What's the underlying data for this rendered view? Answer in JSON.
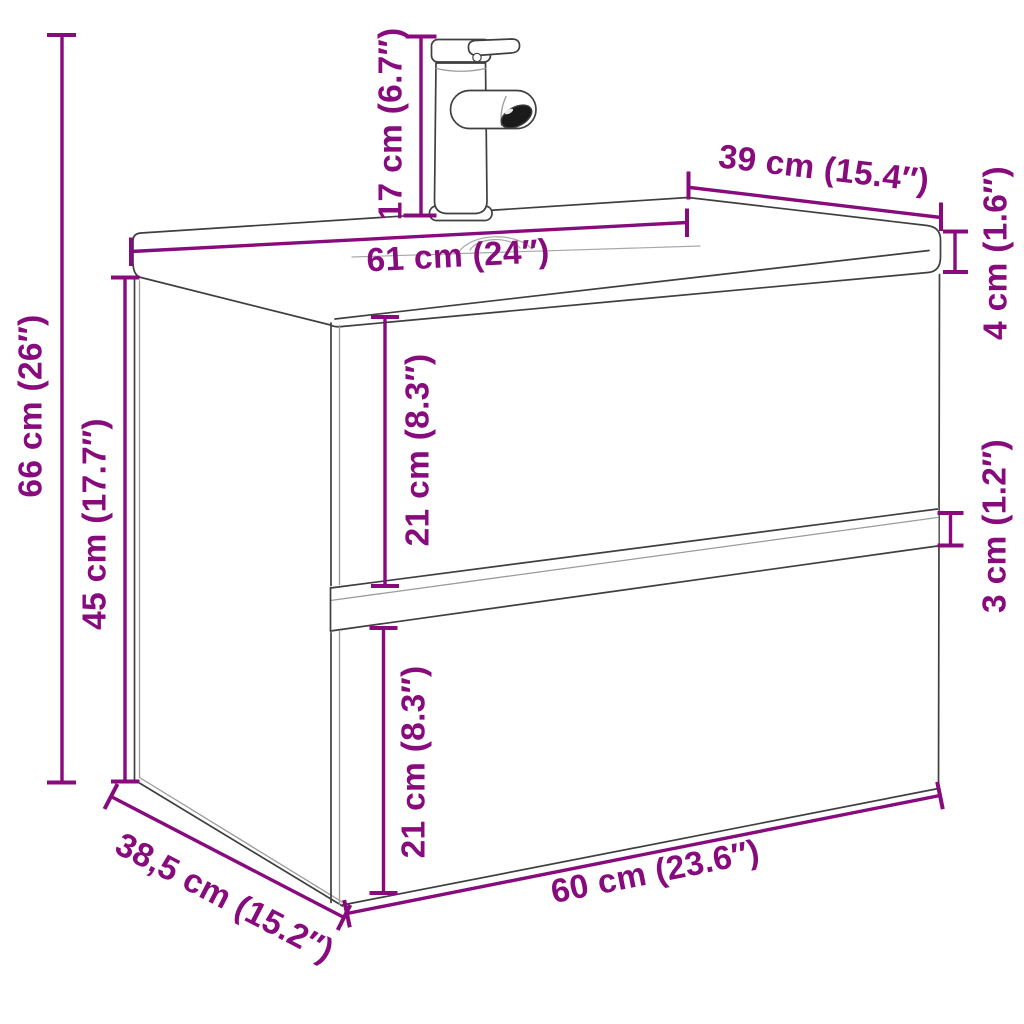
{
  "diagram": {
    "kind": "product-dimension-diagram",
    "subject": "wall-mounted bathroom vanity cabinet with integrated washbasin and mixer faucet, two drawers",
    "units_primary": "cm",
    "units_secondary": "inches"
  },
  "colors": {
    "dimension_magenta": "#870b7d",
    "outline_gray": "#3f3f3f",
    "light_gray": "#9b9b9b",
    "aerator_black": "#1a1a1a",
    "background": "#ffffff"
  },
  "dimensions": {
    "faucet_height": {
      "label": "17 cm (6.7″)",
      "cm": 17,
      "inches": 6.7
    },
    "basin_depth": {
      "label": "39 cm (15.4″)",
      "cm": 39,
      "inches": 15.4
    },
    "basin_width": {
      "label": "61 cm (24″)",
      "cm": 61,
      "inches": 24
    },
    "basin_thickness": {
      "label": "4 cm (1.6″)",
      "cm": 4,
      "inches": 1.6
    },
    "total_height": {
      "label": "66 cm (26″)",
      "cm": 66,
      "inches": 26
    },
    "cabinet_height": {
      "label": "45 cm (17.7″)",
      "cm": 45,
      "inches": 17.7
    },
    "upper_drawer_height": {
      "label": "21 cm (8.3″)",
      "cm": 21,
      "inches": 8.3
    },
    "drawer_gap": {
      "label": "3 cm (1.2″)",
      "cm": 3,
      "inches": 1.2
    },
    "lower_drawer_height": {
      "label": "21 cm (8.3″)",
      "cm": 21,
      "inches": 8.3
    },
    "cabinet_width": {
      "label": "60 cm (23.6″)",
      "cm": 60,
      "inches": 23.6
    },
    "cabinet_depth": {
      "label": "38,5 cm (15.2″)",
      "cm": 38.5,
      "inches": 15.2
    }
  }
}
